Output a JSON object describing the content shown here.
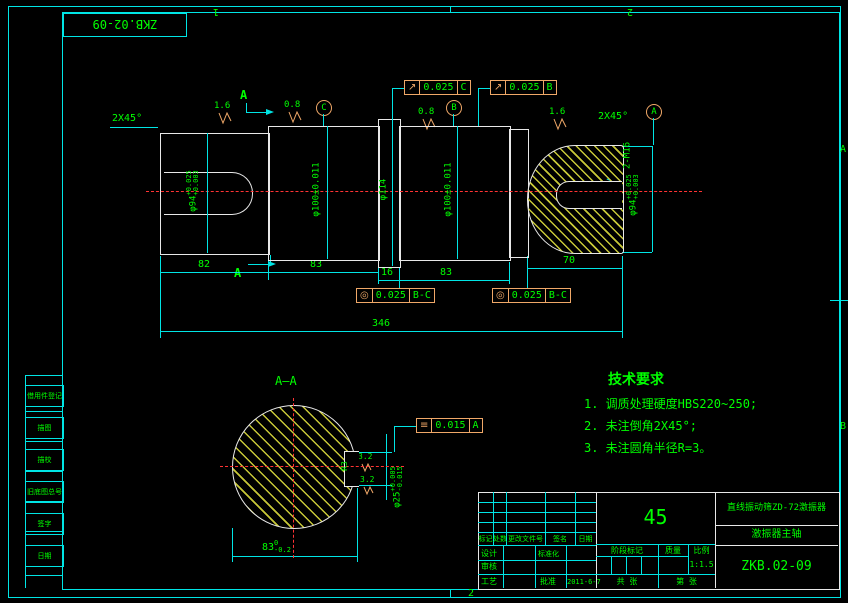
{
  "colors": {
    "background": "#000000",
    "frame": "#00e5e5",
    "geometry": "#e8e8e8",
    "annotation_text": "#00ff00",
    "centerline": "#ff3333",
    "hatch": "#c8c838",
    "gdt_frame": "#f0a868"
  },
  "sheet": {
    "code": "ZKB.02-09",
    "zone_top_1": "1",
    "zone_top_2": "2",
    "zone_bottom_2": "2",
    "zone_right_a": "A",
    "zone_right_b": "B"
  },
  "main": {
    "chamfer_left": "2X45°",
    "chamfer_right": "2X45°",
    "rough_1": "1.6",
    "rough_2": "0.8",
    "rough_3": "0.8",
    "rough_4": "1.6",
    "datum_a": "A",
    "datum_b": "B",
    "datum_c": "C",
    "section_letter_top": "A",
    "section_letter_bottom": "A",
    "fcf_runout_c": {
      "sym": "↗",
      "val": "0.025",
      "dat": "C"
    },
    "fcf_runout_b": {
      "sym": "↗",
      "val": "0.025",
      "dat": "B"
    },
    "fcf_conc_1": {
      "sym": "◎",
      "val": "0.025",
      "dat": "B-C"
    },
    "fcf_conc_2": {
      "sym": "◎",
      "val": "0.025",
      "dat": "B-C"
    },
    "dia_94_left": {
      "base": "φ94",
      "sup": "+0.025",
      "sub": "+0.003"
    },
    "dia_100_left": "φ100±0.011",
    "dia_114": "φ114",
    "dia_100_right": "φ100±0.011",
    "dia_94_right": {
      "base": "φ94",
      "sup": "+0.025",
      "sub": "+0.003"
    },
    "thread": "2-M16",
    "dim_82": "82",
    "dim_83a": "83",
    "dim_16": "16",
    "dim_83b": "83",
    "dim_70": "70",
    "dim_346": "346"
  },
  "section": {
    "title": "A—A",
    "radius": "R3",
    "rough_1": "3.2",
    "rough_2": "3.2",
    "fcf_sym": {
      "sym": "≡",
      "val": "0.015",
      "dat": "A"
    },
    "dia_25": {
      "base": "φ25",
      "sup": "+0.005",
      "sub": "-0.015"
    },
    "dim_83": {
      "base": "83",
      "sup": "0",
      "sub": "-0.2"
    }
  },
  "tech": {
    "title": "技术要求",
    "items": [
      "1. 调质处理硬度HBS220~250;",
      "2. 未注倒角2X45°;",
      "3. 未注圆角半径R=3。"
    ]
  },
  "title_block": {
    "rev_labels": [
      "标记",
      "处数",
      "更改文件号",
      "签名",
      "日期"
    ],
    "design": "设计",
    "check": "审核",
    "process": "工艺",
    "standard": "标准化",
    "approve": "批准",
    "date": "2011-6-7",
    "material": "45",
    "stage_label": "阶段标记",
    "mass_label": "质量",
    "scale_label": "比例",
    "scale": "1:1.5",
    "sheets_total": "共 张",
    "sheet_no": "第 张",
    "product": "直线振动筛ZD-72激振器",
    "part": "激振器主轴",
    "drawing_no": "ZKB.02-09"
  },
  "sidebar": {
    "items": [
      "借用件登记",
      "描图",
      "描校",
      "旧底图总号",
      "签字",
      "日期"
    ]
  }
}
